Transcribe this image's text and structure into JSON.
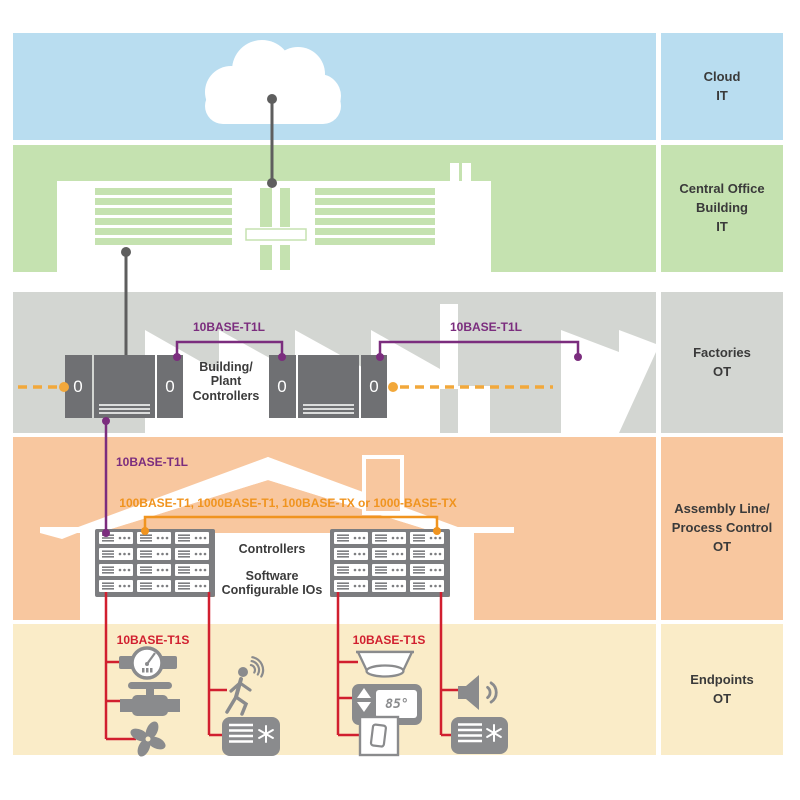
{
  "palette": {
    "cloud_band": "#b9ddf0",
    "office_band": "#c5e2b0",
    "factory_band": "#d3d6d2",
    "assembly_band": "#f8c79f",
    "endpoint_band": "#faecc8",
    "purple_link": "#7b2d7e",
    "orange_link": "#f0941f",
    "red_link": "#d11f2f",
    "cabinet_gray": "#6f7073",
    "icon_gray": "#8a8b8d",
    "connector_gray": "#5e5e5e",
    "text_dark": "#3a3a3a"
  },
  "layers": [
    {
      "id": "cloud",
      "label": "Cloud\nIT"
    },
    {
      "id": "central-office",
      "label": "Central Office\nBuilding\nIT"
    },
    {
      "id": "factories",
      "label": "Factories\nOT"
    },
    {
      "id": "assembly",
      "label": "Assembly Line/\nProcess Control\nOT"
    },
    {
      "id": "endpoints",
      "label": "Endpoints\nOT"
    }
  ],
  "connections": {
    "factory_link_left": "10BASE-T1L",
    "factory_link_right": "10BASE-T1L",
    "assembly_uplink": "10BASE-T1L",
    "assembly_bus": "100BASE-T1, 1000BASE-T1, 100BASE-TX or 1000-BASE-TX",
    "endpoint_bus_left": "10BASE-T1S",
    "endpoint_bus_right": "10BASE-T1S"
  },
  "factories": {
    "controllers_label": "Building/\nPlant\nControllers",
    "cabinet_display": "0"
  },
  "assembly": {
    "controllers_label": "Controllers",
    "io_label": "Software\nConfigurable IOs"
  },
  "endpoints": {
    "thermostat_reading": "85°"
  }
}
